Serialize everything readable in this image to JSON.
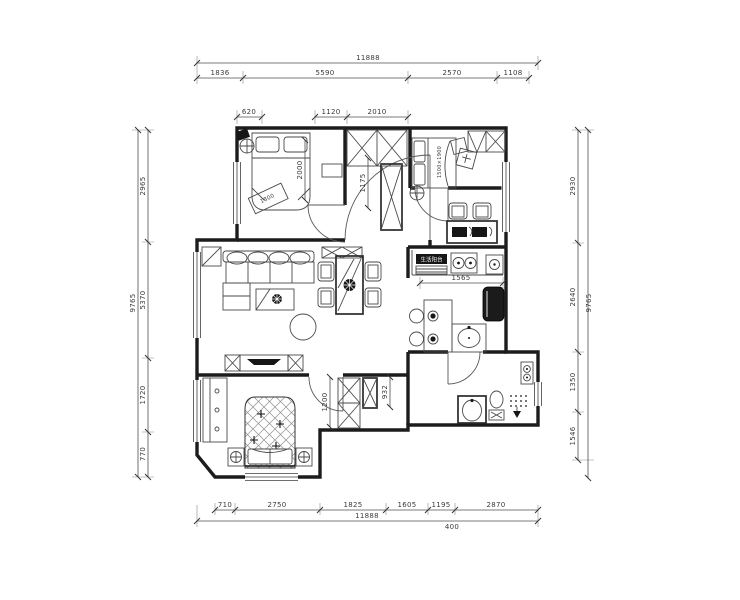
{
  "drawing": {
    "type": "apartment floor plan",
    "background": "#ffffff",
    "line_color": "#3a3a3a",
    "wall_color": "#1c1c1c"
  },
  "dims": {
    "top": {
      "total": "11888",
      "segments": [
        "1836",
        "5590",
        "2570",
        "1108"
      ]
    },
    "bottom": {
      "total": "11888",
      "offset": "400",
      "segments": [
        "710",
        "2750",
        "1825",
        "1605",
        "1195",
        "2870"
      ]
    },
    "left": {
      "total": "9765",
      "segments": [
        "2965",
        "5370",
        "1720",
        "770"
      ]
    },
    "right": {
      "total": "9765",
      "segments": [
        "2930",
        "2640",
        "1350",
        "1546"
      ]
    },
    "interior": {
      "closet_width": "620",
      "wardrobe_a": "1120",
      "wardrobe_b": "2010",
      "bed_length": "2000",
      "bed_width": "1800",
      "hall_width": "1175",
      "counter_length": "1565",
      "door_clearance": "1200",
      "cabinet_width": "932",
      "bed2_size": "1500×1900"
    }
  },
  "labels": {
    "kitchen_box": "生活阳台"
  }
}
